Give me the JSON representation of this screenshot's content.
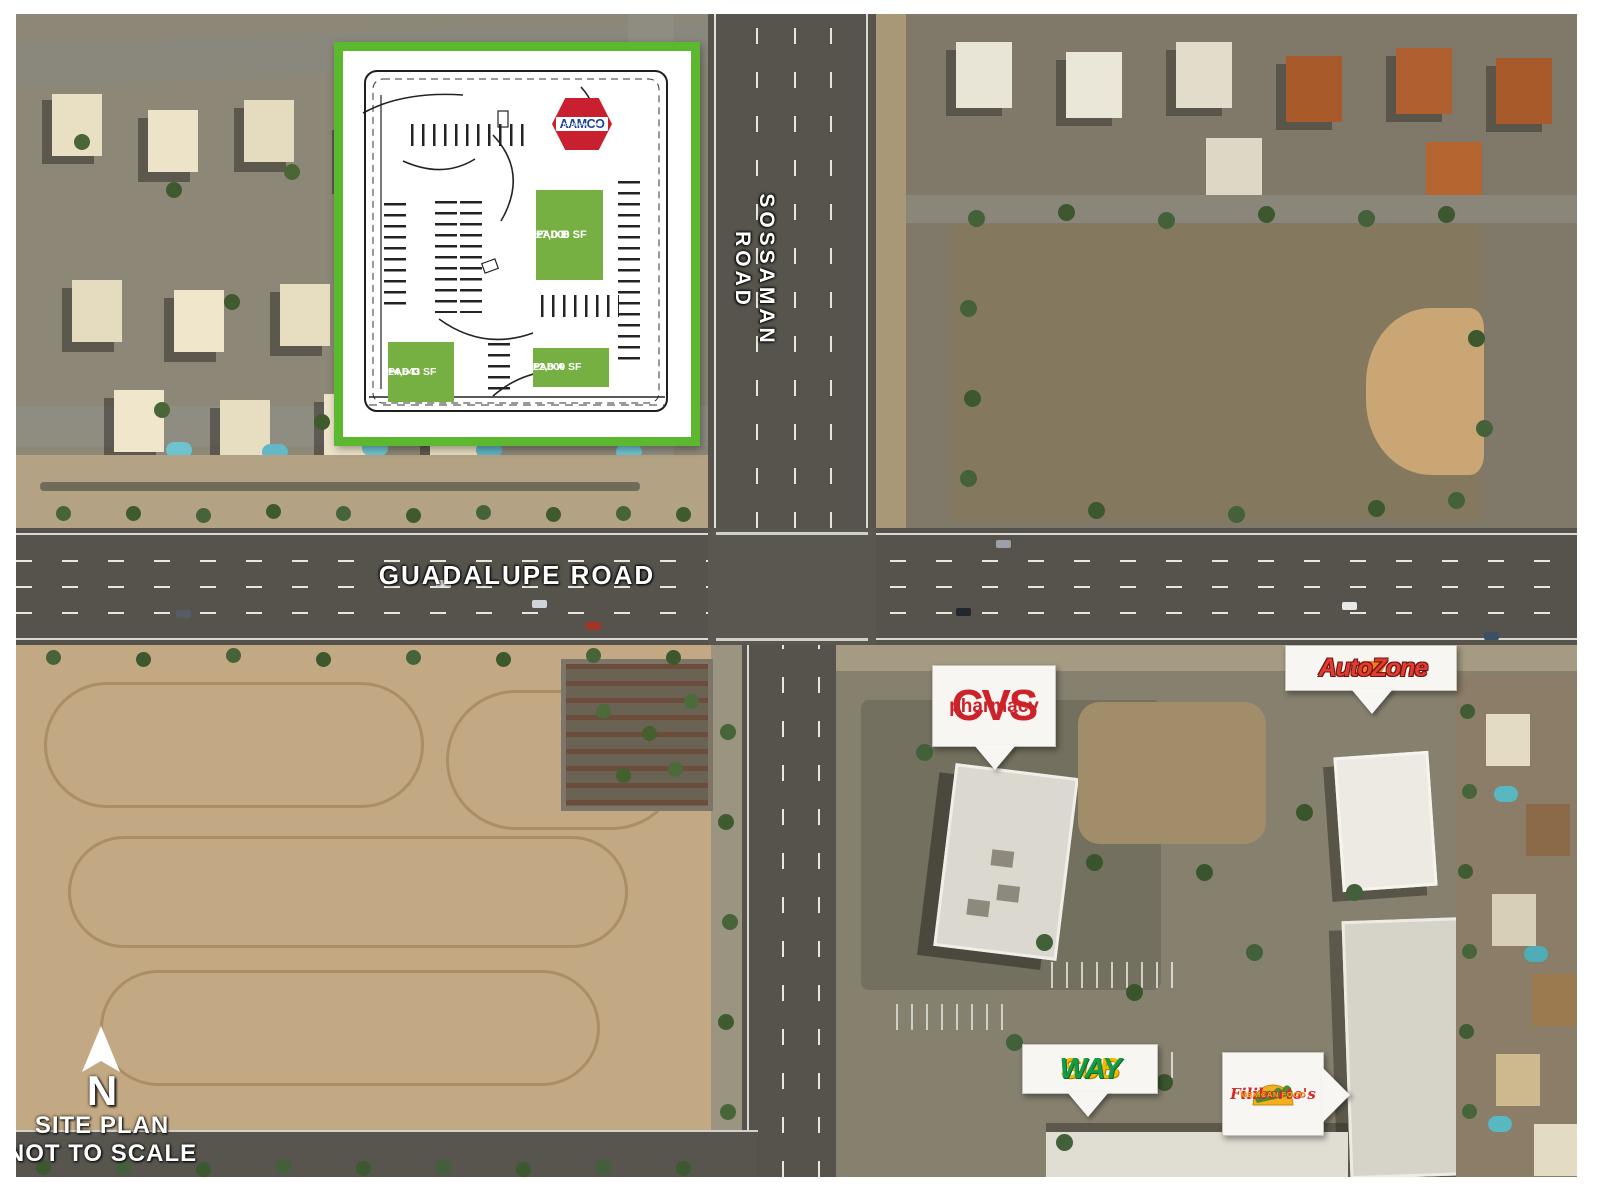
{
  "site_plan": {
    "aamco": {
      "line_top": "TRANSMISSIONS",
      "brand": "AAMCO",
      "line_bottom": "TOTAL CAR CARE"
    },
    "pads": [
      {
        "name": "PAD B",
        "size": "±7,000 SF"
      },
      {
        "name": "PAD D",
        "size": "±4,643 SF"
      },
      {
        "name": "PAD A",
        "size": "±2,800 SF"
      }
    ]
  },
  "road_labels": {
    "vertical": "SOSSAMAN ROAD",
    "horizontal": "GUADALUPE ROAD"
  },
  "retailer_callouts": {
    "cvs": {
      "line1": "CVS",
      "line2": "pharmacy"
    },
    "autozone": {
      "name": "AutoZone"
    },
    "subway": {
      "part1": "SUB",
      "part2": "WAY"
    },
    "filibertos": {
      "name": "Filiberto's",
      "subtitle": "MEXICAN FOOD"
    }
  },
  "compass": {
    "letter": "N",
    "caption_line1": "SITE PLAN",
    "caption_line2": "NOT TO SCALE"
  },
  "colors": {
    "plan_border_green": "#5cb82e",
    "pad_green": "#76b043",
    "aamco_red": "#c8202f",
    "aamco_blue": "#1b3f94",
    "cvs_red": "#cc2229",
    "autozone_red": "#e03c31",
    "autozone_orange": "#f47b20",
    "subway_yellow": "#f5b800",
    "subway_green": "#169b47",
    "filibertos_red": "#d02c2f",
    "filibertos_yellow": "#f2a71b"
  }
}
